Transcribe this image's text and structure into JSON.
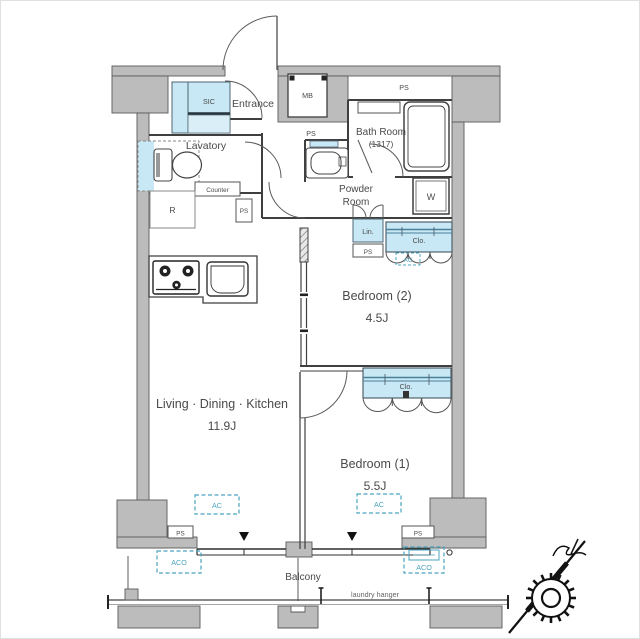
{
  "plan": {
    "rooms": {
      "entrance": "Entrance",
      "sic": "SIC",
      "lavatory": "Lavatory",
      "counter": "Counter",
      "refrigerator": "R",
      "bath_room_line1": "Bath Room",
      "bath_room_line2": "(1317)",
      "powder_room_line1": "Powder",
      "powder_room_line2": "Room",
      "washer": "W",
      "linen": "Lin.",
      "meter_box": "MB",
      "bedroom2_name": "Bedroom (2)",
      "bedroom2_size": "4.5J",
      "ldk_name": "Living · Dining · Kitchen",
      "ldk_size": "11.9J",
      "bedroom1_name": "Bedroom (1)",
      "bedroom1_size": "5.5J",
      "balcony": "Balcony"
    },
    "labels": {
      "ps": "PS",
      "closet": "Clo.",
      "ac": "AC",
      "aco": "ACO",
      "laundry_hanger": "laundry hanger"
    },
    "colors": {
      "wall_gray": "#bcbcbc",
      "wall_stroke": "#5a5a5a",
      "line_dark": "#3f3f3f",
      "fixture_blue": "#c8e8f5",
      "fixture_blue_light": "#daeef8",
      "hatch_blue": "#4a7e99",
      "accent_teal": "#4ba4bf",
      "text_gray": "#4a4a4a"
    }
  }
}
